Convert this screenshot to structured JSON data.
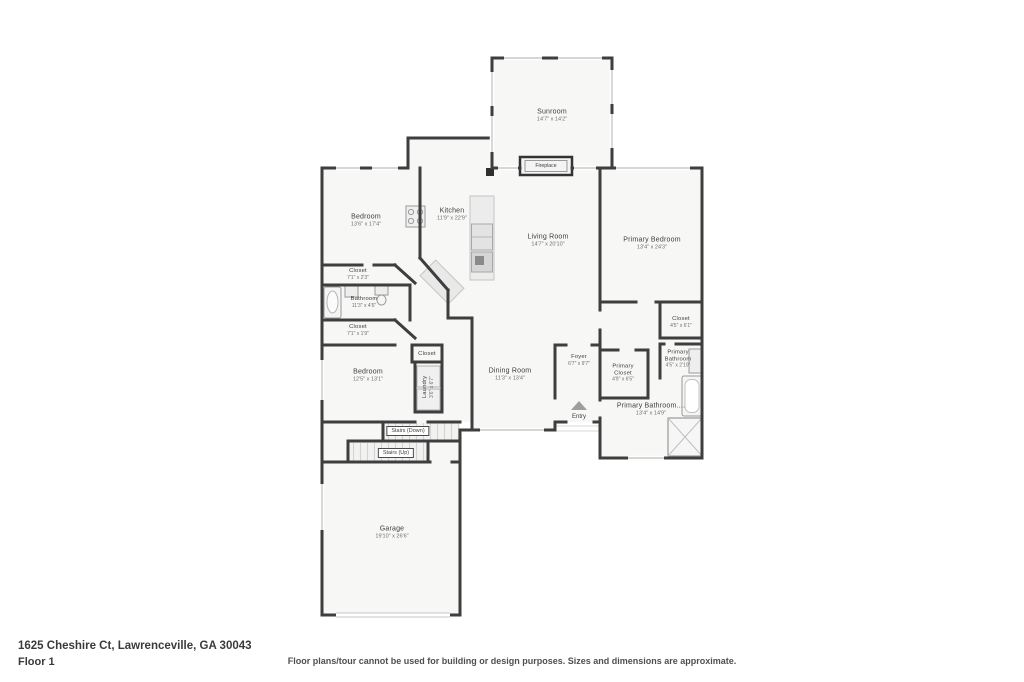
{
  "plan": {
    "rooms": [
      {
        "name": "Sunroom",
        "dims": "14'7\" x 14'2\""
      },
      {
        "name": "Bedroom",
        "dims": "13'6\" x 17'4\""
      },
      {
        "name": "Kitchen",
        "dims": "11'9\" x 22'9\""
      },
      {
        "name": "Living Room",
        "dims": "14'7\" x 20'10\""
      },
      {
        "name": "Primary Bedroom",
        "dims": "13'4\" x 24'3\""
      },
      {
        "name": "Closet",
        "dims": "7'1\" x 2'3\""
      },
      {
        "name": "Bathroom",
        "dims": "11'3\" x 4'6\""
      },
      {
        "name": "Closet",
        "dims": "7'1\" x 1'9\""
      },
      {
        "name": "Closet"
      },
      {
        "name": "Bedroom",
        "dims": "12'5\" x 13'1\""
      },
      {
        "name": "Laundry",
        "dims": "3'6\" x 6'7\""
      },
      {
        "name": "Dining Room",
        "dims": "11'3\" x 13'4\""
      },
      {
        "name": "Foyer",
        "dims": "6'7\" x 9'7\""
      },
      {
        "name": "Primary Closet",
        "dims": "4'9\" x 6'5\""
      },
      {
        "name": "Closet",
        "dims": "4'5\" x 6'1\""
      },
      {
        "name": "Primary Bathroom",
        "dims": "4'5\" x 2'10\""
      },
      {
        "name": "Primary Bathroom....",
        "dims": "13'4\" x 14'9\""
      },
      {
        "name": "Garage",
        "dims": "19'10\" x 26'6\""
      }
    ],
    "misc": {
      "fireplace": "Fireplace",
      "entry": "Entry",
      "stairs_down": "Stairs (Down)",
      "stairs_up": "Stairs (Up)"
    }
  },
  "footer": {
    "address": "1625 Cheshire Ct, Lawrenceville, GA 30043",
    "floor": "Floor 1",
    "disclaimer": "Floor plans/tour cannot be used for building or design purposes. Sizes and dimensions are approximate."
  },
  "colors": {
    "wall": "#3e3e3e",
    "room_fill": "#f7f7f6",
    "window": "#c9c9c9",
    "text": "#3d3d3d"
  }
}
